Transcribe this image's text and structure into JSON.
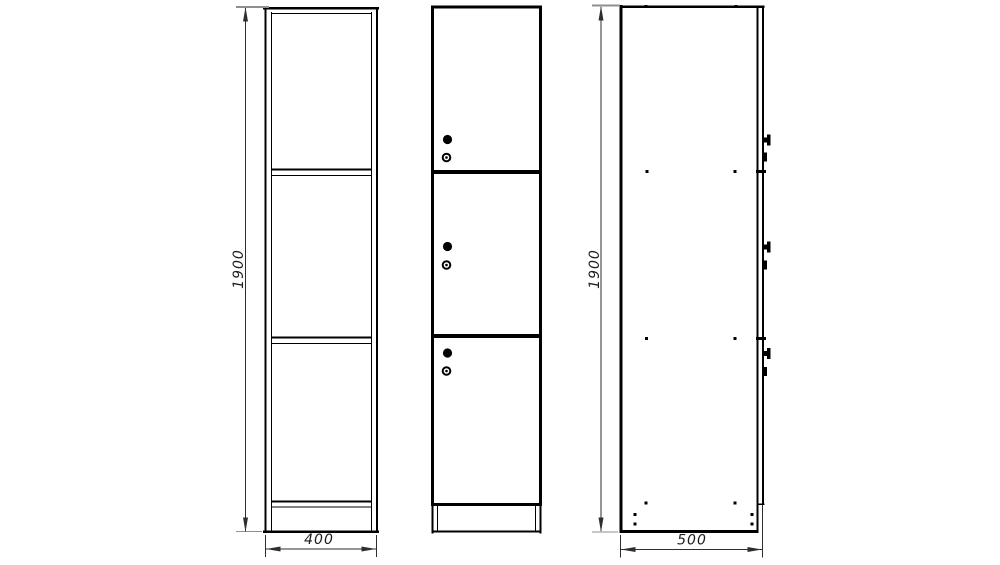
{
  "colors": {
    "bg": "#ffffff",
    "line": "#000000",
    "dim": "#2e2e2e",
    "ext": "#8f8f8f",
    "txt": "#1c1c1c"
  },
  "dimensions": {
    "front_height": "1900",
    "front_width": "400",
    "side_height": "1900",
    "side_depth": "500"
  },
  "symbols": {
    "lock_knob": "filled-circle",
    "keyhole": "circle-with-center-dot",
    "screw": "small-square-dot",
    "cam_lock_side": "t-shaped-protrusion",
    "latch_side": "small-rect-protrusion"
  }
}
